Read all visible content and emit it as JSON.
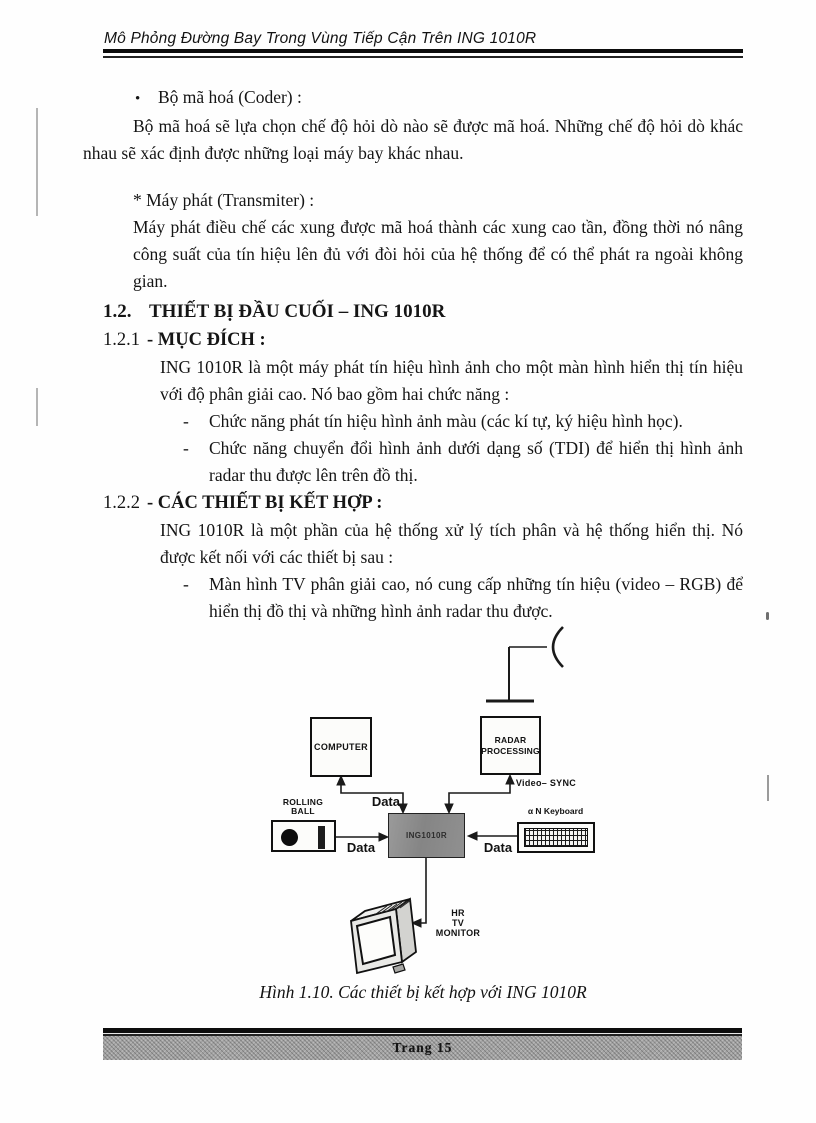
{
  "header": {
    "title": "Mô Phỏng Đường Bay Trong Vùng Tiếp Cận Trên ING 1010R"
  },
  "content": {
    "bullet_marker": "•",
    "coder_item": "Bộ mã hoá (Coder) :",
    "coder_para": "Bộ mã hoá sẽ lựa chọn chế độ hỏi dò nào sẽ được mã hoá. Những chế độ hỏi dò khác nhau sẽ xác định được những loại máy bay khác nhau.",
    "transmitter_item": "* Máy phát (Transmiter) :",
    "transmitter_para": "Máy phát điều chế các xung được mã hoá thành các xung cao tần, đồng thời nó nâng công suất của tín hiệu lên đủ với đòi hỏi của hệ thống để có thể phát ra ngoài không gian.",
    "section_12": {
      "number": "1.2.",
      "title": "THIẾT BỊ ĐẦU CUỐI – ING 1010R"
    },
    "section_121": {
      "number": "1.2.1",
      "title": "- MỤC ĐÍCH :"
    },
    "purpose_para": "ING 1010R là một máy phát tín hiệu hình ảnh cho một màn hình hiển thị tín hiệu với độ phân giải cao. Nó bao gồm hai chức năng :",
    "list_marker": "-",
    "purpose_list": [
      "Chức năng phát tín hiệu hình ảnh màu (các kí tự, ký hiệu hình học).",
      "Chức năng chuyển đổi hình ảnh dưới dạng số (TDI) để hiển thị hình ảnh radar thu được lên trên đồ thị."
    ],
    "section_122": {
      "number": "1.2.2",
      "title": "- CÁC THIẾT BỊ KẾT HỢP :"
    },
    "combined_para": "ING 1010R là một phần của hệ thống xử lý tích phân và hệ thống hiển thị. Nó được kết nối với các thiết bị sau :",
    "combined_list": [
      "Màn hình TV phân giải cao, nó cung cấp những tín hiệu (video – RGB) để hiển thị đồ thị và những hình ảnh radar thu được."
    ],
    "caption": "Hình 1.10. Các thiết bị kết hợp với ING 1010R"
  },
  "diagram": {
    "computer": "COMPUTER",
    "radar_line1": "RADAR",
    "radar_line2": "PROCESSING",
    "ing": "ING1010R",
    "rolling_line1": "ROLLING",
    "rolling_line2": "BALL",
    "keyboard": "α N Keyboard",
    "video_sync": "Video– SYNC",
    "data_top": "Data",
    "data_left": "Data",
    "data_right": "Data",
    "monitor_line1": "HR",
    "monitor_line2": "TV",
    "monitor_line3": "MONITOR",
    "colors": {
      "ing_fill": "#8d8d8d",
      "footer_band": "#a3a3a3",
      "ink": "#111111"
    }
  },
  "footer": {
    "page_label": "Trang 15"
  }
}
